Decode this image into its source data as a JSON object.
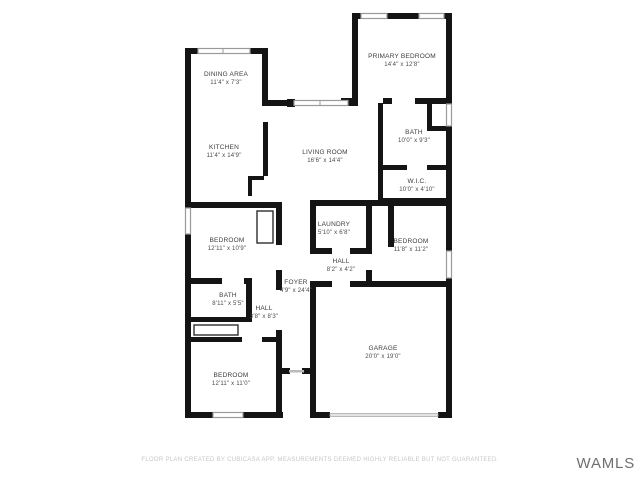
{
  "plan": {
    "title": "Residential floor plan",
    "colors": {
      "wall": "#141414",
      "window_frame": "#9a9a9a",
      "label_text": "#3c3c3c",
      "disclaimer_text": "#c7c7c7",
      "watermark_text": "#6f6f6f",
      "background": "#ffffff"
    }
  },
  "rooms": [
    {
      "name": "DINING AREA",
      "dims": "11'4\" x 7'3\""
    },
    {
      "name": "KITCHEN",
      "dims": "11'4\" x 14'9\""
    },
    {
      "name": "PRIMARY BEDROOM",
      "dims": "14'4\" x 12'8\""
    },
    {
      "name": "LIVING ROOM",
      "dims": "16'6\" x 14'4\""
    },
    {
      "name": "BATH",
      "dims": "10'0\" x 9'3\""
    },
    {
      "name": "W.I.C.",
      "dims": "10'0\" x 4'10\""
    },
    {
      "name": "LAUNDRY",
      "dims": "5'10\" x 6'8\""
    },
    {
      "name": "BEDROOM",
      "dims": "11'8\" x 11'2\""
    },
    {
      "name": "HALL",
      "dims": "8'2\" x 4'2\""
    },
    {
      "name": "BEDROOM",
      "dims": "12'11\" x 10'9\""
    },
    {
      "name": "FOYER",
      "dims": "4'9\" x 24'4\""
    },
    {
      "name": "BATH",
      "dims": "8'11\" x 5'5\""
    },
    {
      "name": "HALL",
      "dims": "3'8\" x 8'3\""
    },
    {
      "name": "BEDROOM",
      "dims": "12'11\" x 11'0\""
    },
    {
      "name": "GARAGE",
      "dims": "20'0\" x 19'0\""
    }
  ],
  "footer": {
    "disclaimer": "FLOOR PLAN CREATED BY CUBICASA APP. MEASUREMENTS DEEMED HIGHLY RELIABLE BUT NOT GUARANTEED."
  },
  "watermark": "WAMLS"
}
